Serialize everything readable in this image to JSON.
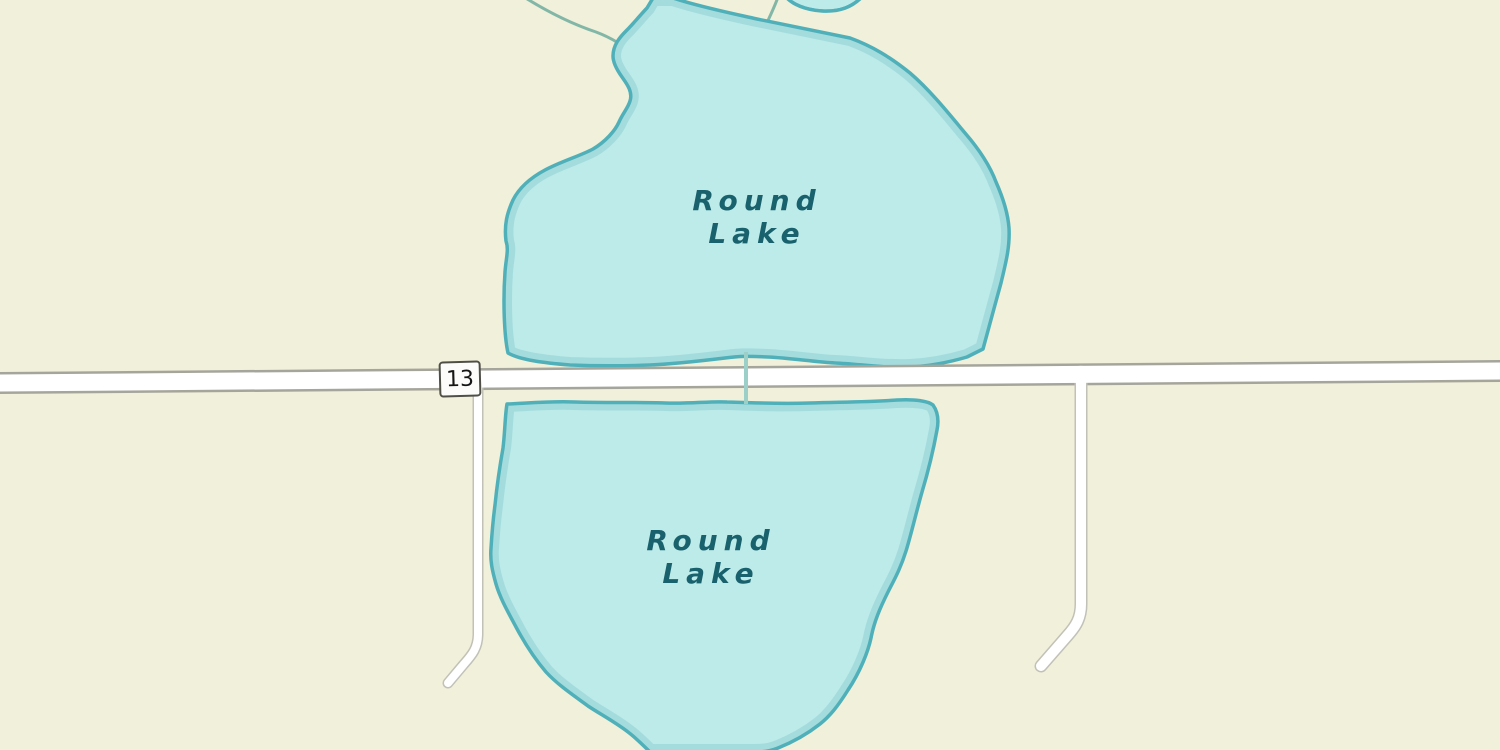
{
  "map": {
    "type": "street-map-tile-view",
    "shield": {
      "route_number": "13"
    },
    "lakes": {
      "north": {
        "name": "Round Lake",
        "label_line1": "Round",
        "label_line2": "Lake"
      },
      "south": {
        "name": "Round Lake",
        "label_line1": "Round",
        "label_line2": "Lake"
      }
    },
    "colors": {
      "land": "#f1f0da",
      "water_fill": "#bdebe9",
      "water_inner_shadow": "#8fd0d3",
      "water_outline": "#4fb0ba",
      "water_label_text": "#18616d",
      "stream": "#82b7a7",
      "main_road_fill": "#ffffff",
      "main_road_casing": "#a6a59c",
      "minor_road_fill": "#ffffff",
      "minor_road_casing": "#c2c1b8",
      "shield_background": "#fcfcfa",
      "shield_border": "#4f4f48",
      "shield_text": "#151515"
    }
  }
}
